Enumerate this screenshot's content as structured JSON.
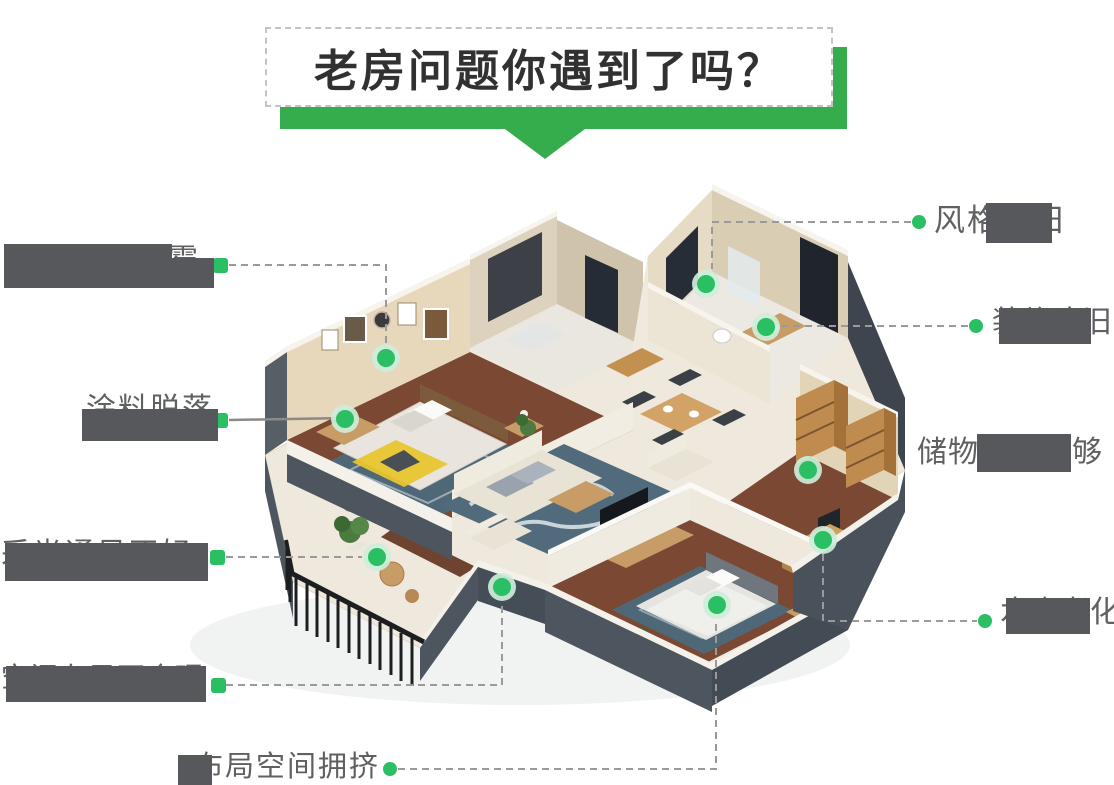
{
  "title": {
    "text": "老房问题你遇到了吗？"
  },
  "problems": {
    "l1": "墙面开裂发霉",
    "l2": "涂料脱落",
    "l3": "采光通风不好",
    "l4": "空间布局不合理",
    "b1": "布局空间拥挤",
    "r1": "风格陈旧",
    "r2": "装修陈旧",
    "r3": "储物空间不够",
    "r4": "水电老化"
  },
  "hotspots": [
    "master-bedroom-wall",
    "master-bedroom-bench",
    "shower-room",
    "bathroom",
    "study-bookshelf",
    "study-desk",
    "balcony",
    "living-room-edge",
    "second-bedroom-bed"
  ],
  "colors": {
    "accent_green": "#35ad4d",
    "marker_green": "#2abf63",
    "marker_halo": "#cdeeda",
    "label_text": "#5f6062",
    "connector_gray": "#9a9a9a",
    "redaction_gray": "#57585b",
    "title_text": "#313131"
  }
}
